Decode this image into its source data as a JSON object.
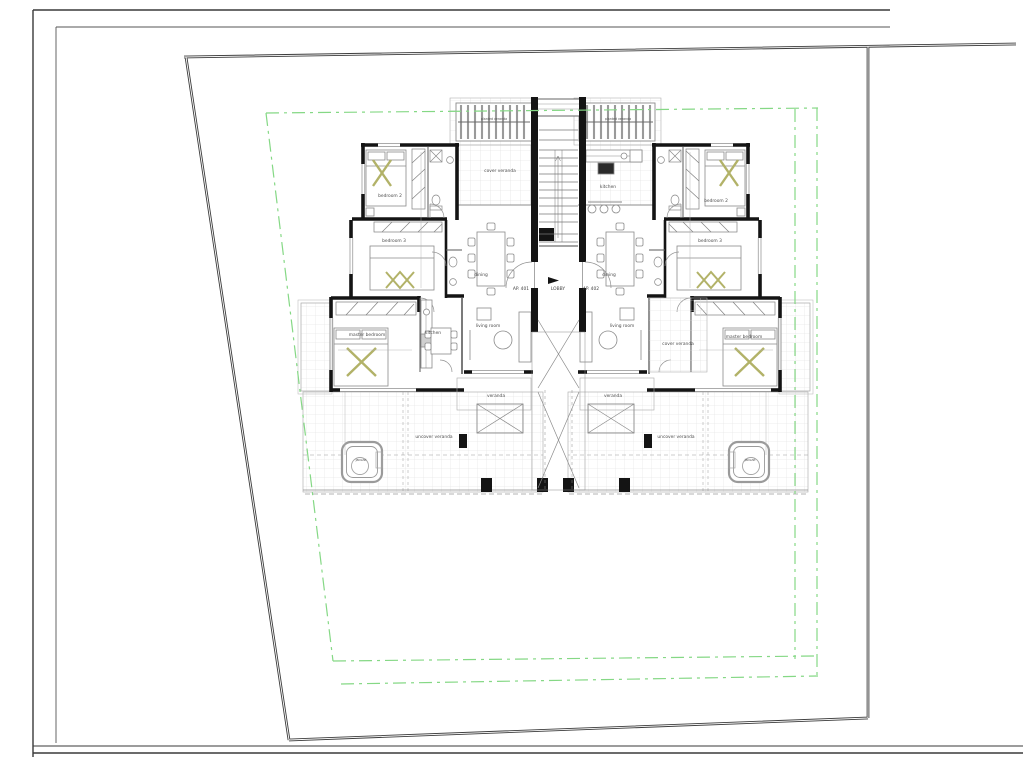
{
  "drawing": {
    "type": "architectural floor plan, two-unit apartment level",
    "colors": {
      "paper": "#ffffff",
      "wall": "#141414",
      "thin_line": "#8c8c8c",
      "tile_grid": "#d9d9d9",
      "setback_green": "#85d885",
      "plot_boundary": "#3c3c3c",
      "furniture_accent": "#b2b268"
    }
  },
  "rooms": {
    "left": {
      "bedroom2": "bedroom 2",
      "bedroom3": "bedroom 3",
      "master": "master bedroom",
      "kitchen": "kitchen",
      "living": "living room",
      "dining": "dining",
      "cover_veranda": "cover veranda",
      "veranda": "veranda",
      "uncover_veranda": "uncover veranda",
      "jacuzzi": "jacuzzi",
      "pergola": "planted veranda"
    },
    "right": {
      "bedroom2": "bedroom 2",
      "bedroom3": "bedroom 3",
      "master": "master bedroom",
      "kitchen": "kitchen",
      "living": "living room",
      "dining": "dining",
      "cover_veranda": "cover veranda",
      "veranda": "veranda",
      "uncover_veranda": "uncover veranda",
      "jacuzzi": "jacuzzi",
      "pergola": "planted veranda"
    },
    "core": {
      "lobby": "LOBBY",
      "apartment_left": "AP. 401",
      "apartment_right": "AP. 402"
    }
  }
}
